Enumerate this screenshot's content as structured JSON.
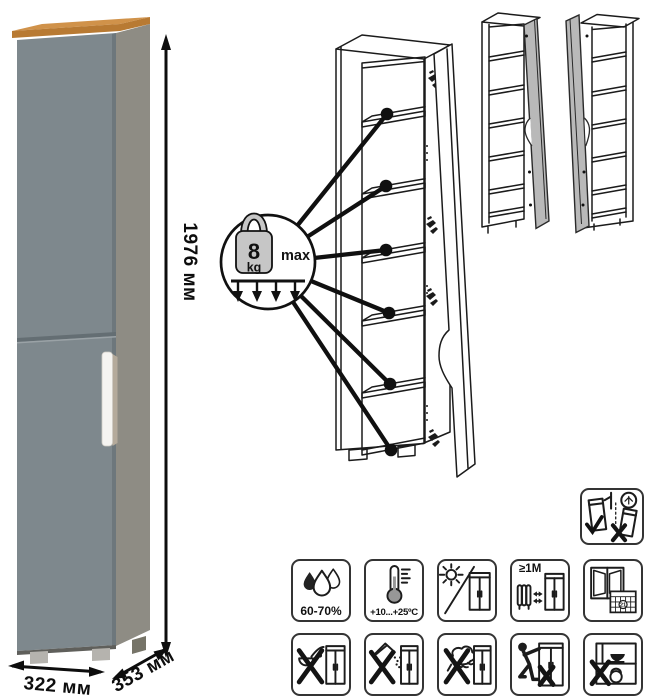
{
  "dimensions": {
    "height": "1976 мм",
    "width": "322 мм",
    "depth": "353 мм"
  },
  "shelf_load": {
    "value": "8",
    "unit": "kg",
    "qualifier": "max"
  },
  "care_icons": {
    "humidity": {
      "name": "humidity-range",
      "label": "60-70%"
    },
    "temperature": {
      "name": "temperature-range",
      "label": "+10...+25ºC"
    },
    "sunlight": {
      "name": "avoid-direct-sunlight"
    },
    "heat_distance": {
      "name": "keep-distance-from-heat",
      "label": "≥1M"
    },
    "ventilation": {
      "name": "ventilate-room-calendar",
      "calendar_day": "21"
    },
    "no_liquids": {
      "name": "no-pouring-liquids"
    },
    "no_powder": {
      "name": "no-abrasive-powder"
    },
    "no_sponge": {
      "name": "no-abrasive-sponge"
    },
    "no_drag": {
      "name": "do-not-drag-when-moving"
    },
    "no_overload": {
      "name": "do-not-overload"
    },
    "wall_mount": {
      "name": "secure-to-wall"
    }
  },
  "colors": {
    "line": "#1b1b1b",
    "door_front": "#7e888d",
    "door_front_dark": "#67727700",
    "door_seam": "#646e73",
    "side_panel": "#8e8c84",
    "side_panel_dark": "#767468",
    "wood_top": "#d0924a",
    "wood_front": "#b87a33",
    "handle": "#f5f4f1",
    "handle_shadow": "#b4aa9b",
    "feet": "#b5b3ae",
    "mini_door": "#b9b9b9",
    "weight_fill": "#c6c6c6"
  }
}
